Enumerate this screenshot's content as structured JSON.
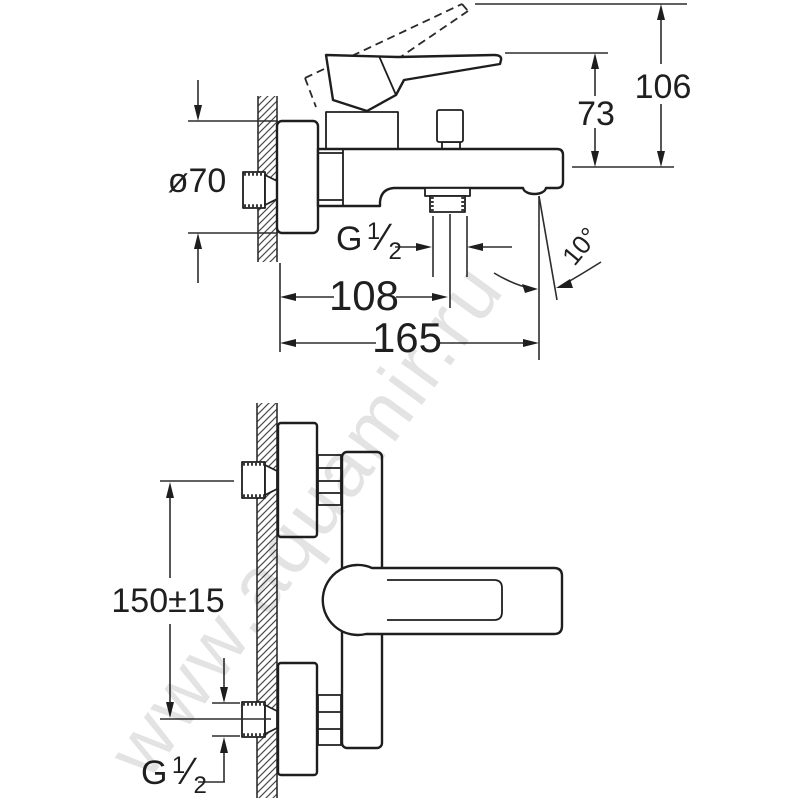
{
  "side_view": {
    "labels": {
      "flange_diameter": "ø70",
      "total_height": "106",
      "lever_height": "73",
      "wall_to_outlet": "108",
      "wall_to_spout_tip": "165",
      "spout_angle": "10°",
      "outlet_thread": {
        "prefix": "G",
        "numerator": "1",
        "slash": "⁄",
        "denominator": "2"
      }
    }
  },
  "front_view": {
    "labels": {
      "inlet_spacing": "150±15",
      "inlet_thread": {
        "prefix": "G",
        "numerator": "1",
        "slash": "⁄",
        "denominator": "2"
      }
    }
  },
  "watermark": {
    "text": "www.aquamir.ru"
  }
}
